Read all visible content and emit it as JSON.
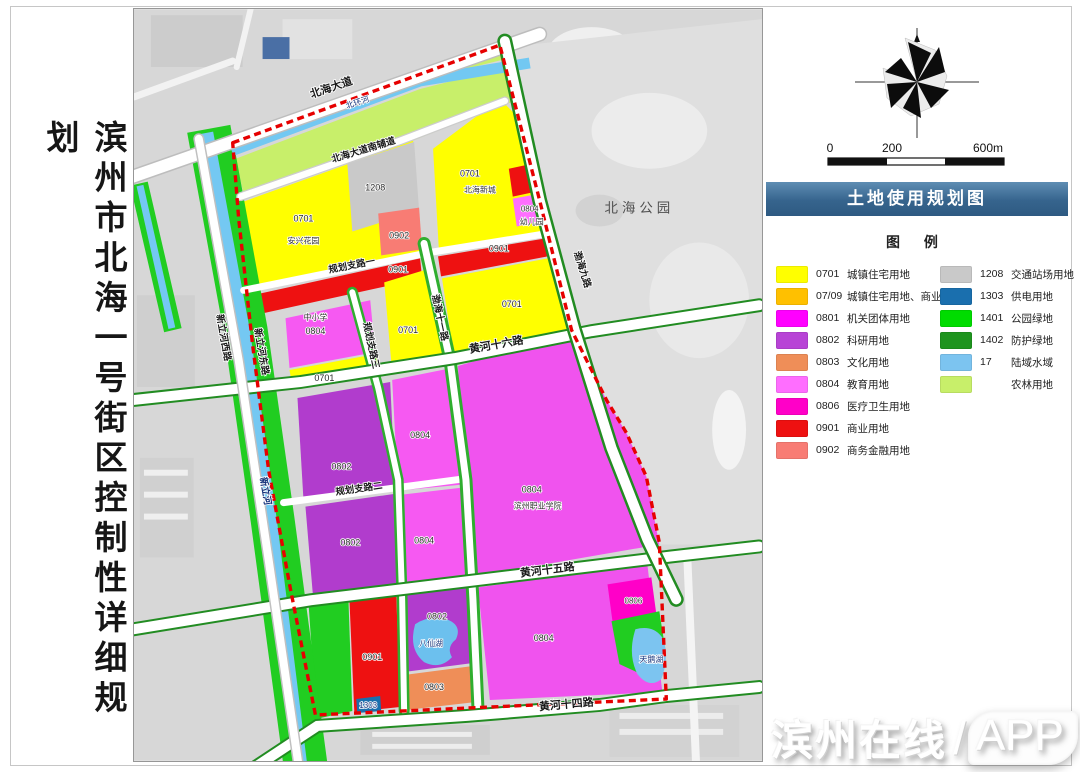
{
  "page": {
    "title": "滨州市北海一号街区控制性详细规划"
  },
  "right_panel": {
    "map_title": "土地使用规划图",
    "legend_title": "图 例",
    "banner_color": "#36648d",
    "scale": {
      "t0": "0",
      "t200": "200",
      "t600": "600m"
    },
    "legend_left": [
      {
        "code": "0701",
        "label": "城镇住宅用地",
        "color": "#FFFF00"
      },
      {
        "code": "07/09",
        "label": "城镇住宅用地、商业用地",
        "color": "#FFC000"
      },
      {
        "code": "0801",
        "label": "机关团体用地",
        "color": "#FF00FF"
      },
      {
        "code": "0802",
        "label": "科研用地",
        "color": "#B843D6"
      },
      {
        "code": "0803",
        "label": "文化用地",
        "color": "#EF8E58"
      },
      {
        "code": "0804",
        "label": "教育用地",
        "color": "#FF6EFF"
      },
      {
        "code": "0806",
        "label": "医疗卫生用地",
        "color": "#FF00C8"
      },
      {
        "code": "0901",
        "label": "商业用地",
        "color": "#EE1111"
      },
      {
        "code": "0902",
        "label": "商务金融用地",
        "color": "#F87C74"
      }
    ],
    "legend_right": [
      {
        "code": "1208",
        "label": "交通站场用地",
        "color": "#C9C9C9"
      },
      {
        "code": "1303",
        "label": "供电用地",
        "color": "#1A6FAE"
      },
      {
        "code": "1401",
        "label": "公园绿地",
        "color": "#00DC00"
      },
      {
        "code": "1402",
        "label": "防护绿地",
        "color": "#1E941E"
      },
      {
        "code": "17",
        "label": "陆域水域",
        "color": "#7CC4F0"
      },
      {
        "code": "",
        "label": "农林用地",
        "color": "#C8EF6A"
      }
    ]
  },
  "map": {
    "roads": {
      "beihai_avenue": "北海大道",
      "south_fudao": "北海大道南辅道",
      "guihua1": "规划支路一",
      "guihua2": "规划支路二",
      "guihua3": "规划支路三",
      "bohai9": "渤海九路",
      "bohai11": "渤海十一路",
      "huanghe16": "黄河十六路",
      "huanghe15": "黄河十五路",
      "huanghe14": "黄河十四路",
      "xinlihe_west_rd": "新立河西路",
      "xinlihe_east_rd": "新立河东路"
    },
    "water": {
      "beihuanhe": "北环河",
      "xinlihe": "新立河",
      "baxianhu": "八仙湖",
      "tianehu": "天鹅湖"
    },
    "parcels": {
      "c0701": "0701",
      "c0802": "0802",
      "c0803": "0803",
      "c0804": "0804",
      "c0806": "0806",
      "c0901": "0901",
      "c0902": "0902",
      "c1208": "1208",
      "c1303": "1303"
    },
    "places": {
      "anxing": "安兴花园",
      "beihaixincheng": "北海新城",
      "youeryuan": "幼儿园",
      "zhongxiaoxue": "中小学",
      "binzhouzhiyuan": "滨州职业学院",
      "park": "北海公园"
    }
  },
  "watermark": {
    "name": "滨州在线",
    "slash": "/",
    "suffix": "APP"
  }
}
